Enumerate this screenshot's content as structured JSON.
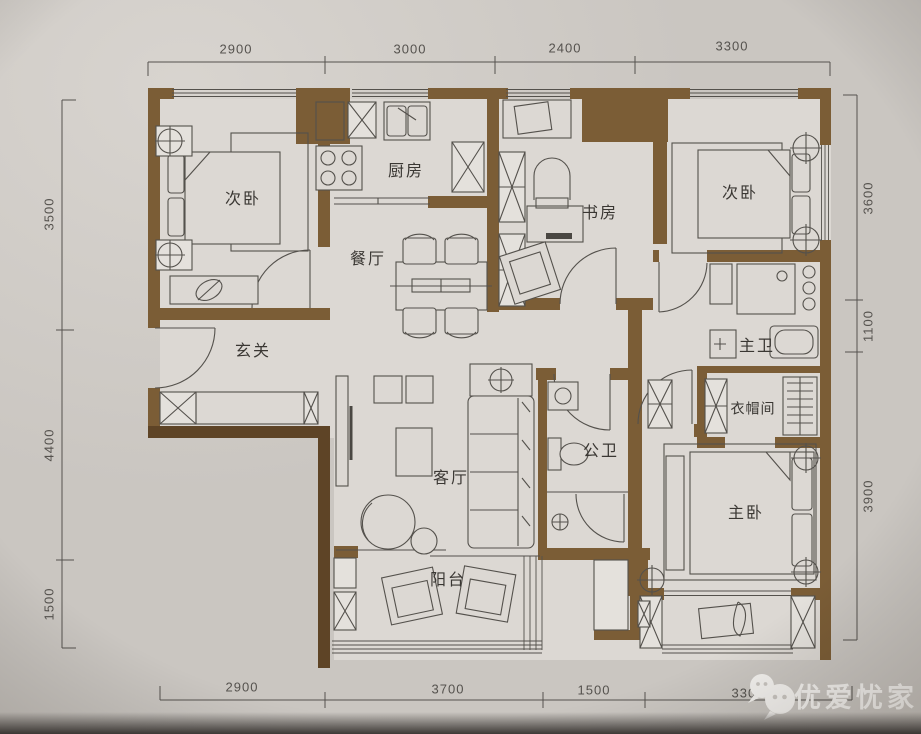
{
  "dimensions": {
    "top": [
      "2900",
      "3000",
      "2400",
      "3300"
    ],
    "bottom": [
      "2900",
      "3700",
      "1500",
      "3300"
    ],
    "left": [
      "3500",
      "4400",
      "1500"
    ],
    "right": [
      "3600",
      "1100",
      "3900"
    ]
  },
  "labels": {
    "bedroom_top_left": "次卧",
    "kitchen": "厨房",
    "dining": "餐厅",
    "study": "书房",
    "bedroom_top_right": "次卧",
    "entry": "玄关",
    "master_bath": "主卫",
    "cloakroom": "衣帽间",
    "living": "客厅",
    "public_bath": "公卫",
    "master_bedroom": "主卧",
    "balcony": "阳台"
  },
  "watermark": {
    "text": "优爱忧家",
    "icon": "wechat-icon"
  },
  "colors": {
    "wall": "#7b5d36",
    "wall_dark": "#5e4426",
    "paper": "#cac6c1",
    "floor": "#dcd8d3",
    "line": "#54514c",
    "dim_text": "#55524e",
    "label_text": "#3a3733",
    "watermark": "#f4f2ef"
  }
}
